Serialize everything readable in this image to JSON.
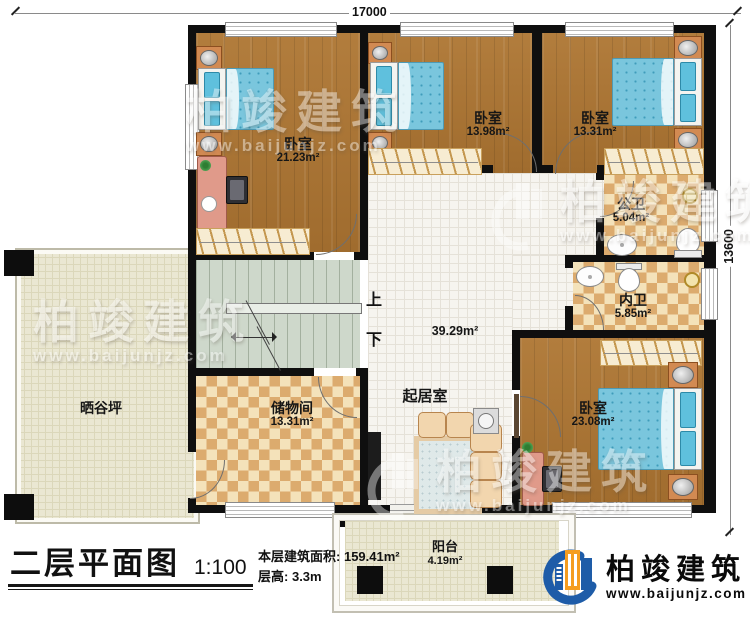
{
  "dims": {
    "top_label": "17000",
    "right_label": "13600"
  },
  "rooms": {
    "bedroom1": {
      "name": "卧室",
      "area": "21.23m²"
    },
    "bedroom2": {
      "name": "卧室",
      "area": "13.98m²"
    },
    "bedroom3": {
      "name": "卧室",
      "area": "13.31m²"
    },
    "bedroom4": {
      "name": "卧室",
      "area": "23.08m²"
    },
    "public_bath": {
      "name": "公卫",
      "area": "5.04m²"
    },
    "ensuite_bath": {
      "name": "内卫",
      "area": "5.85m²"
    },
    "living": {
      "name": "起居室",
      "area": "39.29m²"
    },
    "storage": {
      "name": "储物间",
      "area": "13.31m²"
    },
    "terrace": {
      "name": "晒谷坪"
    },
    "balcony": {
      "name": "阳台",
      "area": "4.19m²"
    }
  },
  "stairs": {
    "up": "上",
    "down": "下"
  },
  "title_block": {
    "plan_title": "二层平面图",
    "scale": "1:100",
    "area_label": "本层建筑面积:",
    "area_value": "159.41m²",
    "height_label": "层高:",
    "height_value": "3.3m"
  },
  "brand": {
    "name": "柏竣建筑",
    "website": "www.baijunjz.com"
  },
  "watermark": {
    "name": "柏竣建筑",
    "website": "www.baijunjz.com"
  },
  "colors": {
    "wall": "#0f0f0f",
    "wood": "#ab7635",
    "checker_dark": "#dcab6e",
    "tile": "#f6f4ef",
    "stairs": "#ced8cb",
    "terrace": "#eae7d2",
    "bed": "#7ac6dd",
    "brand_blue": "#1e5ca8",
    "brand_orange": "#f59d20"
  }
}
